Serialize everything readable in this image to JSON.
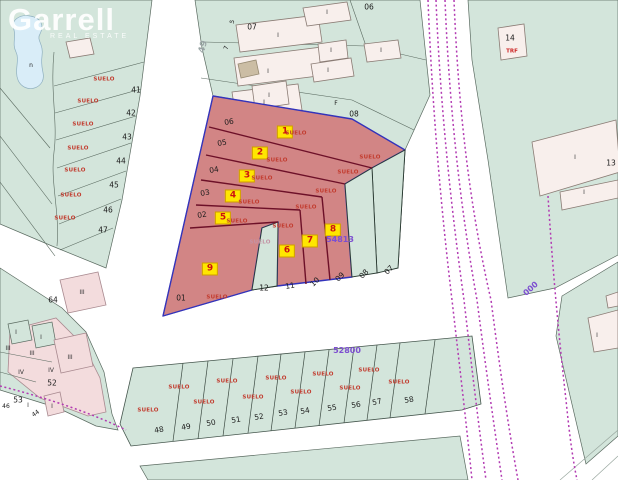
{
  "branding": {
    "name": "Garrell",
    "tagline": "REAL ESTATE"
  },
  "map": {
    "colors": {
      "land": "#d3e5db",
      "highlight": "#d28585",
      "selection": "#3333bb",
      "parcelline": "#6d1028",
      "railway": "#b23ab2",
      "water": "#d9edf8",
      "markerbg": "#ffe600",
      "markertext": "#cc1111",
      "sueloc": "#c23b2e"
    },
    "plot_markers": [
      {
        "number": "1",
        "x": 285,
        "y": 132
      },
      {
        "number": "2",
        "x": 260,
        "y": 153
      },
      {
        "number": "3",
        "x": 247,
        "y": 176
      },
      {
        "number": "4",
        "x": 233,
        "y": 196
      },
      {
        "number": "5",
        "x": 223,
        "y": 218
      },
      {
        "number": "6",
        "x": 287,
        "y": 251
      },
      {
        "number": "7",
        "x": 310,
        "y": 241
      },
      {
        "number": "8",
        "x": 333,
        "y": 230
      },
      {
        "number": "9",
        "x": 210,
        "y": 269
      }
    ],
    "labels": [
      {
        "t": "SUELO",
        "c": "suelo",
        "x": 296,
        "y": 134
      },
      {
        "t": "SUELO",
        "c": "suelo",
        "x": 277,
        "y": 161
      },
      {
        "t": "SUELO",
        "c": "suelo",
        "x": 262,
        "y": 179
      },
      {
        "t": "SUELO",
        "c": "suelo",
        "x": 249,
        "y": 203
      },
      {
        "t": "SUELO",
        "c": "suelo",
        "x": 237,
        "y": 222
      },
      {
        "t": "SUELO",
        "c": "suelo",
        "x": 283,
        "y": 227
      },
      {
        "t": "SUELO",
        "c": "suelo",
        "x": 306,
        "y": 208
      },
      {
        "t": "SUELO",
        "c": "suelo",
        "x": 326,
        "y": 192
      },
      {
        "t": "SUELO",
        "c": "suelo",
        "x": 217,
        "y": 298
      },
      {
        "t": "SUELO",
        "c": "suelo",
        "x": 370,
        "y": 158
      },
      {
        "t": "SUELO",
        "c": "suelo",
        "x": 348,
        "y": 173
      },
      {
        "t": "SUELO",
        "c": "suelo-dim",
        "x": 260,
        "y": 243
      },
      {
        "t": "SUELO",
        "c": "suelo",
        "x": 104,
        "y": 80
      },
      {
        "t": "SUELO",
        "c": "suelo",
        "x": 88,
        "y": 102
      },
      {
        "t": "SUELO",
        "c": "suelo",
        "x": 83,
        "y": 125
      },
      {
        "t": "SUELO",
        "c": "suelo",
        "x": 78,
        "y": 149
      },
      {
        "t": "SUELO",
        "c": "suelo",
        "x": 75,
        "y": 171
      },
      {
        "t": "SUELO",
        "c": "suelo",
        "x": 71,
        "y": 196
      },
      {
        "t": "SUELO",
        "c": "suelo",
        "x": 65,
        "y": 219
      },
      {
        "t": "SUELO",
        "c": "suelo",
        "x": 148,
        "y": 411
      },
      {
        "t": "SUELO",
        "c": "suelo",
        "x": 179,
        "y": 388
      },
      {
        "t": "SUELO",
        "c": "suelo",
        "x": 204,
        "y": 403
      },
      {
        "t": "SUELO",
        "c": "suelo",
        "x": 227,
        "y": 382
      },
      {
        "t": "SUELO",
        "c": "suelo",
        "x": 253,
        "y": 398
      },
      {
        "t": "SUELO",
        "c": "suelo",
        "x": 276,
        "y": 379
      },
      {
        "t": "SUELO",
        "c": "suelo",
        "x": 301,
        "y": 393
      },
      {
        "t": "SUELO",
        "c": "suelo",
        "x": 323,
        "y": 375
      },
      {
        "t": "SUELO",
        "c": "suelo",
        "x": 350,
        "y": 389
      },
      {
        "t": "SUELO",
        "c": "suelo",
        "x": 369,
        "y": 371
      },
      {
        "t": "SUELO",
        "c": "suelo",
        "x": 399,
        "y": 383
      },
      {
        "t": "41",
        "c": "pnum",
        "x": 136,
        "y": 90
      },
      {
        "t": "42",
        "c": "pnum",
        "x": 131,
        "y": 113
      },
      {
        "t": "43",
        "c": "pnum",
        "x": 127,
        "y": 137
      },
      {
        "t": "44",
        "c": "pnum",
        "x": 121,
        "y": 161
      },
      {
        "t": "45",
        "c": "pnum",
        "x": 114,
        "y": 185
      },
      {
        "t": "46",
        "c": "pnum",
        "x": 108,
        "y": 210
      },
      {
        "t": "47",
        "c": "pnum",
        "x": 103,
        "y": 230
      },
      {
        "t": "64",
        "c": "pnum",
        "x": 53,
        "y": 300
      },
      {
        "t": "06",
        "c": "pnum",
        "x": 229,
        "y": 122,
        "r": -10
      },
      {
        "t": "05",
        "c": "pnum",
        "x": 222,
        "y": 143,
        "r": -10
      },
      {
        "t": "04",
        "c": "pnum",
        "x": 214,
        "y": 170,
        "r": -10
      },
      {
        "t": "03",
        "c": "pnum",
        "x": 205,
        "y": 193,
        "r": -10
      },
      {
        "t": "02",
        "c": "pnum",
        "x": 202,
        "y": 215,
        "r": -10
      },
      {
        "t": "01",
        "c": "pnum",
        "x": 181,
        "y": 298
      },
      {
        "t": "12",
        "c": "pnum",
        "x": 264,
        "y": 288
      },
      {
        "t": "11",
        "c": "pnum",
        "x": 290,
        "y": 286,
        "r": -10
      },
      {
        "t": "10",
        "c": "pnum",
        "x": 315,
        "y": 282,
        "r": -45
      },
      {
        "t": "09",
        "c": "pnum",
        "x": 340,
        "y": 277,
        "r": -45
      },
      {
        "t": "08",
        "c": "pnum",
        "x": 364,
        "y": 274,
        "r": -45
      },
      {
        "t": "07",
        "c": "pnum",
        "x": 389,
        "y": 270,
        "r": -45
      },
      {
        "t": "07",
        "c": "pnum",
        "x": 252,
        "y": 27
      },
      {
        "t": "06",
        "c": "pnum",
        "x": 369,
        "y": 7
      },
      {
        "t": "08",
        "c": "pnum",
        "x": 354,
        "y": 114
      },
      {
        "t": "F",
        "c": "tinynum",
        "x": 336,
        "y": 104
      },
      {
        "t": "13",
        "c": "pnum",
        "x": 611,
        "y": 163
      },
      {
        "t": "14",
        "c": "pnum",
        "x": 510,
        "y": 38
      },
      {
        "t": "TRF",
        "c": "trf",
        "x": 512,
        "y": 52
      },
      {
        "t": "48",
        "c": "pnum",
        "x": 159,
        "y": 430,
        "r": -10
      },
      {
        "t": "49",
        "c": "pnum",
        "x": 186,
        "y": 427,
        "r": -10
      },
      {
        "t": "50",
        "c": "pnum",
        "x": 211,
        "y": 423,
        "r": -10
      },
      {
        "t": "51",
        "c": "pnum",
        "x": 236,
        "y": 420,
        "r": -10
      },
      {
        "t": "52",
        "c": "pnum",
        "x": 259,
        "y": 417,
        "r": -10
      },
      {
        "t": "53",
        "c": "pnum",
        "x": 283,
        "y": 413,
        "r": -10
      },
      {
        "t": "54",
        "c": "pnum",
        "x": 305,
        "y": 411,
        "r": -10
      },
      {
        "t": "55",
        "c": "pnum",
        "x": 332,
        "y": 408,
        "r": -10
      },
      {
        "t": "56",
        "c": "pnum",
        "x": 356,
        "y": 405,
        "r": -10
      },
      {
        "t": "57",
        "c": "pnum",
        "x": 377,
        "y": 402,
        "r": -12
      },
      {
        "t": "58",
        "c": "pnum",
        "x": 409,
        "y": 400,
        "r": -10
      },
      {
        "t": "52",
        "c": "pnum",
        "x": 52,
        "y": 383
      },
      {
        "t": "53",
        "c": "pnum",
        "x": 18,
        "y": 400
      },
      {
        "t": "46",
        "c": "tinynum",
        "x": 6,
        "y": 407
      },
      {
        "t": "44",
        "c": "tinynum",
        "x": 36,
        "y": 414,
        "r": -35
      },
      {
        "t": "5",
        "c": "tinynum",
        "x": 233,
        "y": 22,
        "r": -72
      },
      {
        "t": "7",
        "c": "tinynum",
        "x": 227,
        "y": 48,
        "r": -72
      },
      {
        "t": "n",
        "c": "tinynum",
        "x": 31,
        "y": 66
      },
      {
        "t": "49",
        "c": "road-num",
        "x": 204,
        "y": 47,
        "r": -75
      },
      {
        "t": "I",
        "c": "roman",
        "x": 278,
        "y": 36
      },
      {
        "t": "I",
        "c": "roman",
        "x": 268,
        "y": 72
      },
      {
        "t": "I",
        "c": "roman",
        "x": 264,
        "y": 103
      },
      {
        "t": "I",
        "c": "roman",
        "x": 327,
        "y": 13
      },
      {
        "t": "I",
        "c": "roman",
        "x": 331,
        "y": 51
      },
      {
        "t": "I",
        "c": "roman",
        "x": 328,
        "y": 71
      },
      {
        "t": "I",
        "c": "roman",
        "x": 381,
        "y": 51
      },
      {
        "t": "I",
        "c": "roman",
        "x": 269,
        "y": 96
      },
      {
        "t": "I",
        "c": "roman",
        "x": 575,
        "y": 158
      },
      {
        "t": "I",
        "c": "roman",
        "x": 584,
        "y": 193
      },
      {
        "t": "I",
        "c": "roman",
        "x": 597,
        "y": 336
      },
      {
        "t": "I",
        "c": "roman",
        "x": 16,
        "y": 333
      },
      {
        "t": "I",
        "c": "roman",
        "x": 41,
        "y": 338
      },
      {
        "t": "I",
        "c": "roman",
        "x": 28,
        "y": 406
      },
      {
        "t": "I",
        "c": "roman",
        "x": 52,
        "y": 407
      },
      {
        "t": "III",
        "c": "roman",
        "x": 8,
        "y": 349
      },
      {
        "t": "III",
        "c": "roman",
        "x": 32,
        "y": 354
      },
      {
        "t": "III",
        "c": "roman",
        "x": 70,
        "y": 358
      },
      {
        "t": "III",
        "c": "roman",
        "x": 82,
        "y": 293
      },
      {
        "t": "IV",
        "c": "roman",
        "x": 21,
        "y": 373
      },
      {
        "t": "IV",
        "c": "roman",
        "x": 51,
        "y": 371
      },
      {
        "t": "54813",
        "c": "purple",
        "x": 340,
        "y": 240
      },
      {
        "t": "52800",
        "c": "purple",
        "x": 347,
        "y": 351
      },
      {
        "t": "000",
        "c": "purple",
        "x": 531,
        "y": 289,
        "r": -42
      }
    ]
  }
}
